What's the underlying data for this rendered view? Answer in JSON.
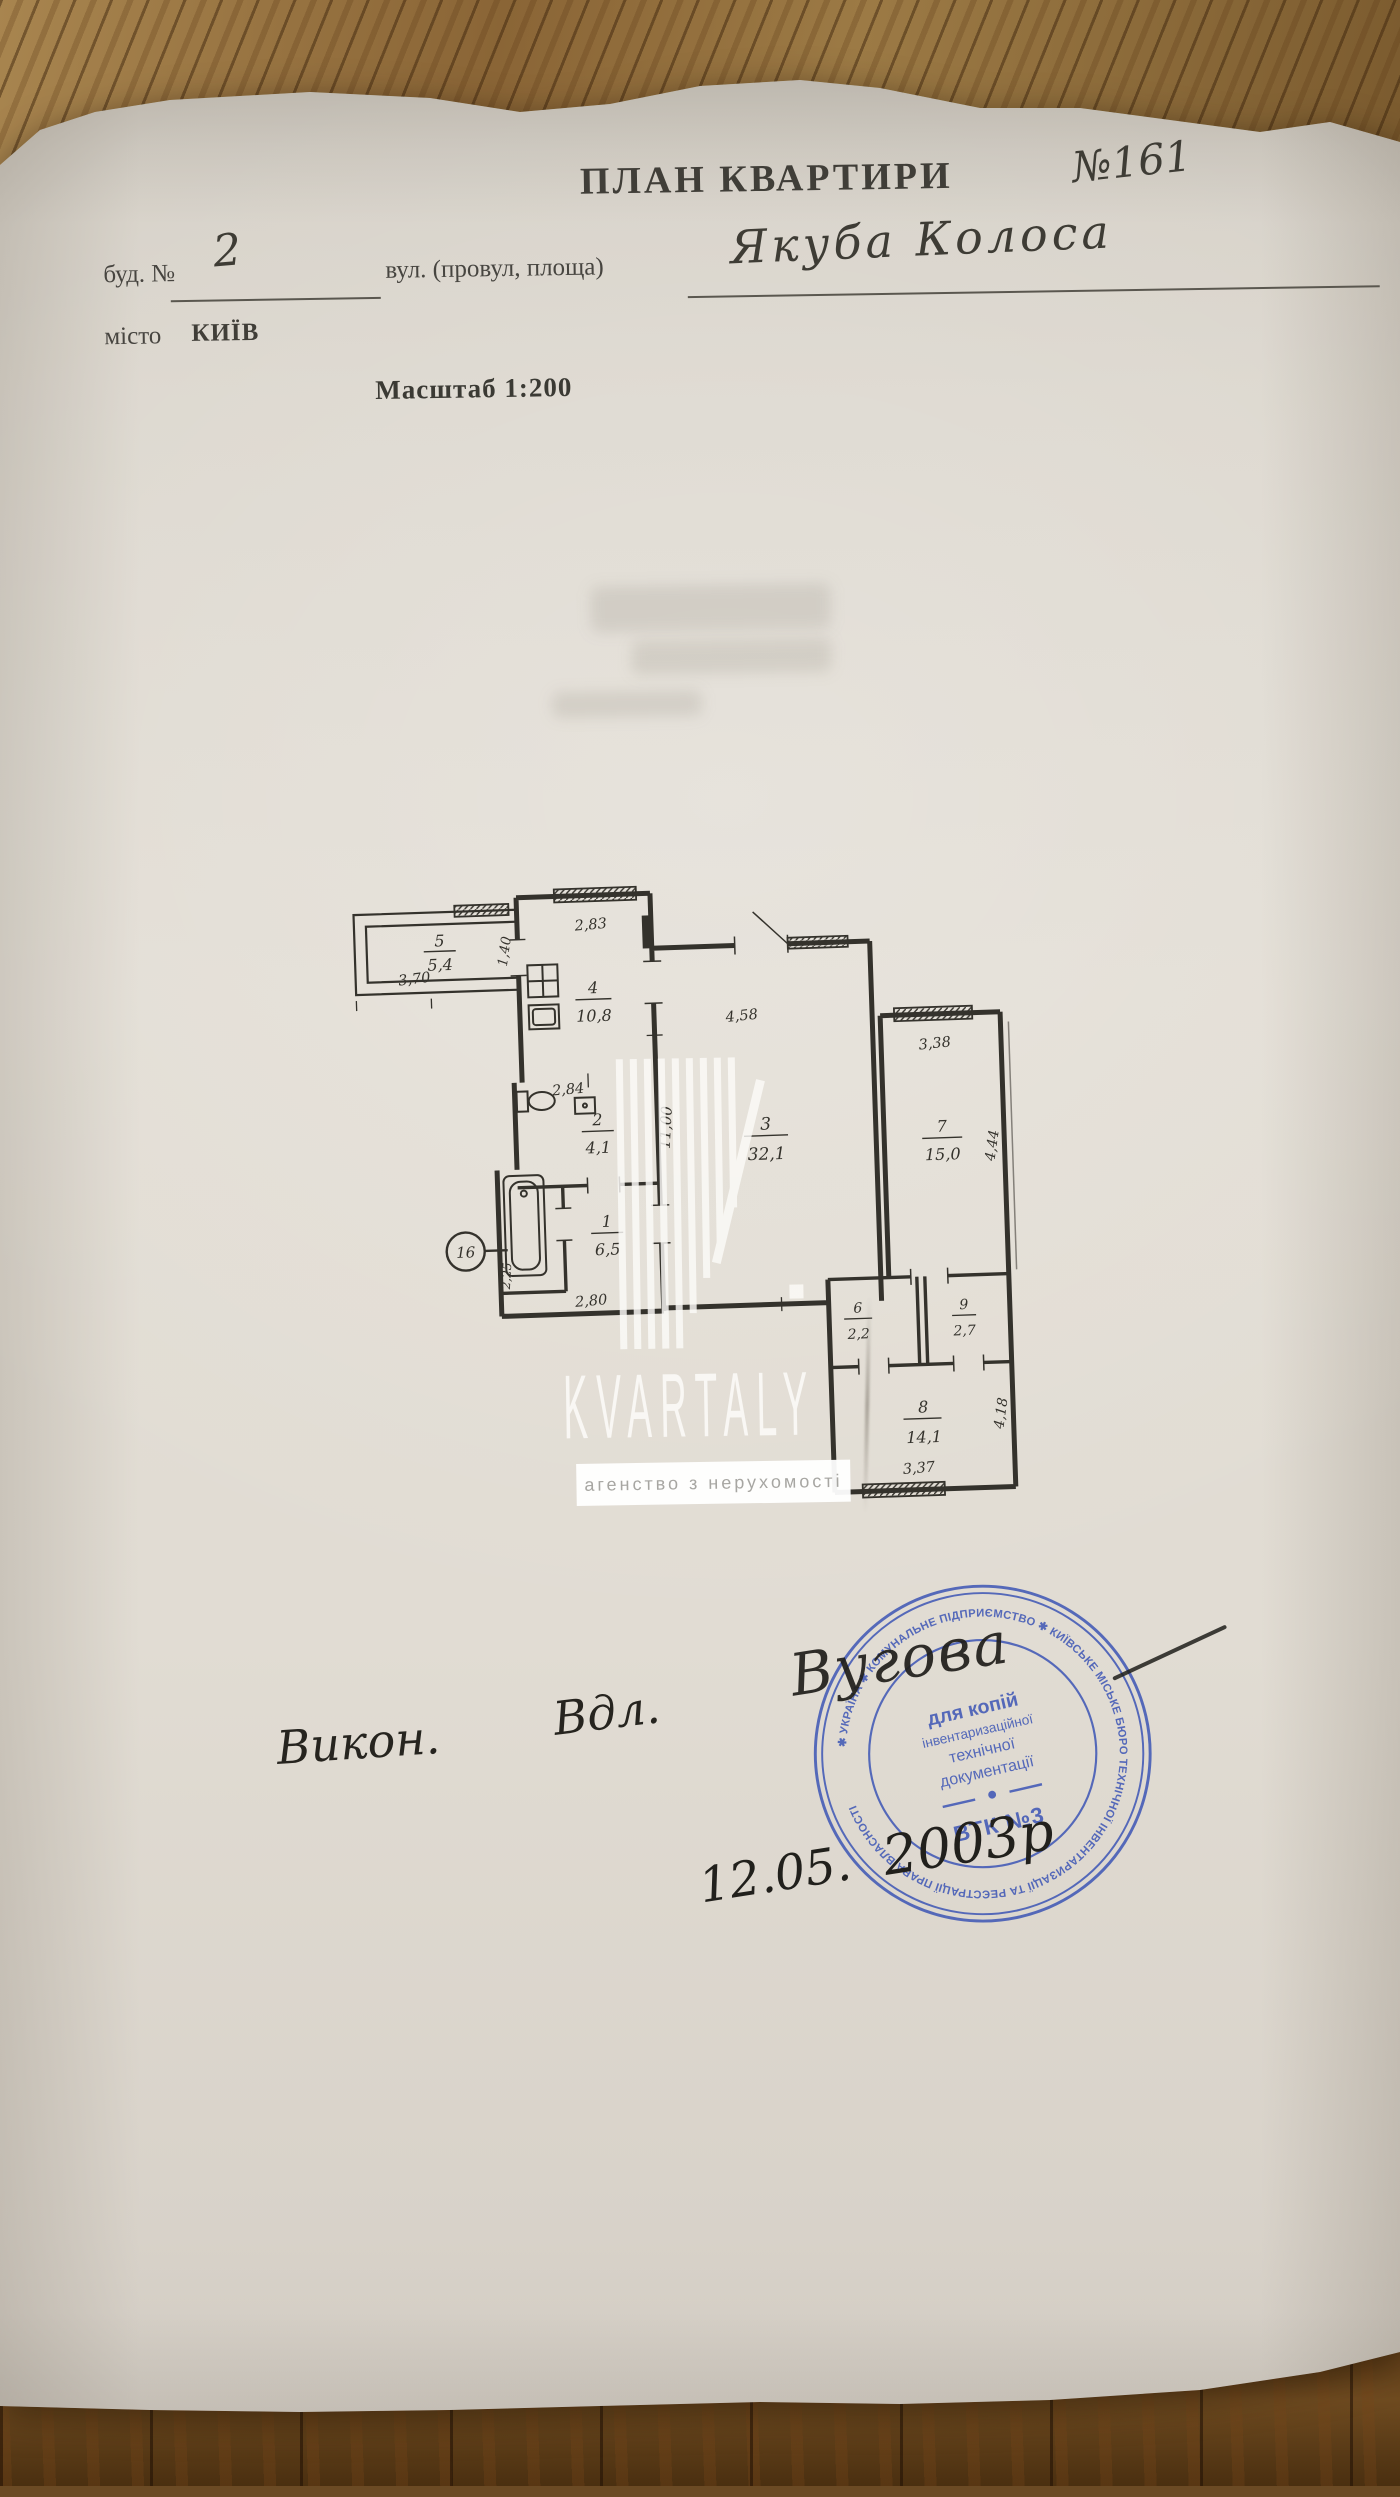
{
  "page": {
    "title": "ПЛАН КВАРТИРИ",
    "apartment_number": "№161",
    "building_label": "буд. №",
    "building_number": "2",
    "street_label": "вул. (провул, площа)",
    "street_name": "Якуба Колоса",
    "city_label": "місто",
    "city_name": "КИЇВ",
    "scale": "Масштаб 1:200"
  },
  "plan": {
    "rooms": [
      {
        "number": "1",
        "area": "6,5"
      },
      {
        "number": "2",
        "area": "4,1"
      },
      {
        "number": "3",
        "area": "32,1"
      },
      {
        "number": "4",
        "area": "10,8"
      },
      {
        "number": "5",
        "area": "5,4"
      },
      {
        "number": "6",
        "area": "2,2"
      },
      {
        "number": "7",
        "area": "15,0"
      },
      {
        "number": "8",
        "area": "14,1"
      },
      {
        "number": "9",
        "area": "2,7"
      }
    ],
    "dimensions": {
      "balcony_width": "3,70",
      "kitchen_width": "2,83",
      "kitchen_side": "1,40",
      "bath_width": "2,84",
      "hall_width": "2,80",
      "hall_side": "2,25",
      "living_width": "4,58",
      "living_depth": "11,00",
      "room7_width": "3,38",
      "room7_depth": "4,44",
      "room8_width": "3,37",
      "room8_depth": "4,18"
    },
    "entrance_mark": "16"
  },
  "watermark": {
    "brand": "KVARTALY",
    "tagline": "агенство з нерухомості"
  },
  "handwriting": {
    "executor_label": "Викон.",
    "executor_signature": "Вдл.",
    "date_day": "12.05.",
    "date_year": "2003р",
    "stamp_signature": "Вугова"
  },
  "stamp": {
    "ring_text": "✱ УКРАЇНА ✱ КОМУНАЛЬНЕ ПІДПРИЄМСТВО ✱ КИЇВСЬКЕ МІСЬКЕ БЮРО ТЕХНІЧНОЇ ІНВЕНТАРИЗАЦІЇ ТА РЕЄСТРАЦІЇ ПРАВА ВЛАСНОСТІ",
    "line1": "для копій",
    "line2": "інвентаризаційної",
    "line3": "технічної",
    "line4": "документації",
    "unit": "ВТК №3"
  },
  "colors": {
    "stamp_blue": "#4159b6",
    "ink": "#34322c",
    "paper": "#e0dbd2",
    "wood": "#7a5a2e"
  }
}
